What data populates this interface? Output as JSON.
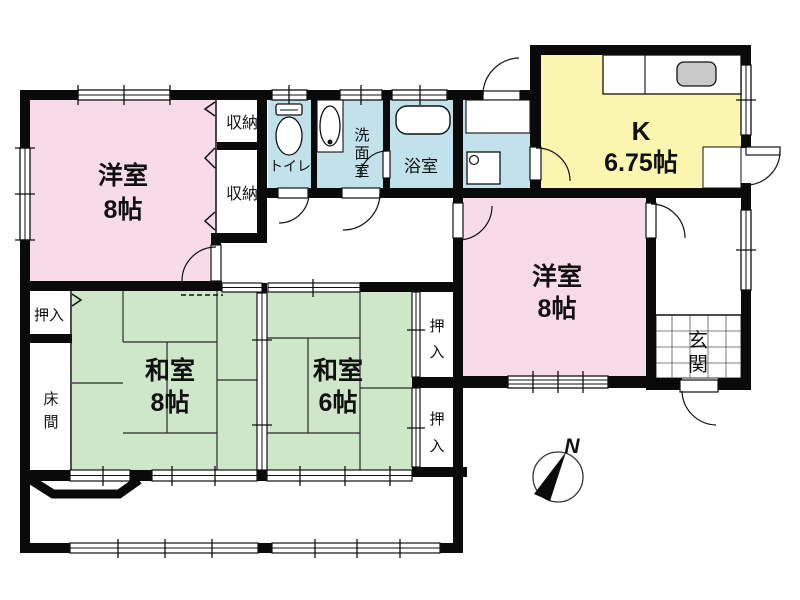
{
  "palette": {
    "wall": "#0a0a0a",
    "pink": "#f8dbe9",
    "green": "#cfe7c9",
    "blue": "#c2e2eb",
    "yellow": "#faf6b0",
    "gray": "#c9c9c9",
    "line": "#2a2a2a",
    "tile_line": "#555555"
  },
  "rooms": {
    "western_left": {
      "label": "洋室",
      "size": "8帖"
    },
    "western_right": {
      "label": "洋室",
      "size": "8帖"
    },
    "japanese_8": {
      "label": "和室",
      "size": "8帖"
    },
    "japanese_6": {
      "label": "和室",
      "size": "6帖"
    },
    "kitchen": {
      "label": "K",
      "size": "6.75帖"
    },
    "toilet": {
      "label": "トイレ"
    },
    "washroom": {
      "chars": [
        "洗",
        "面",
        "室"
      ]
    },
    "bathroom": {
      "label": "浴室"
    },
    "storage_top": {
      "label": "収納"
    },
    "storage_bottom": {
      "label": "収納"
    },
    "closet_left": {
      "label": "押入"
    },
    "closet_right_top": {
      "chars": [
        "押",
        "入"
      ]
    },
    "closet_right_bottom": {
      "chars": [
        "押",
        "入"
      ]
    },
    "entrance": {
      "chars": [
        "玄",
        "関"
      ]
    },
    "alcove": {
      "chars": [
        "床",
        "間"
      ]
    }
  },
  "compass": {
    "north_label": "N"
  }
}
